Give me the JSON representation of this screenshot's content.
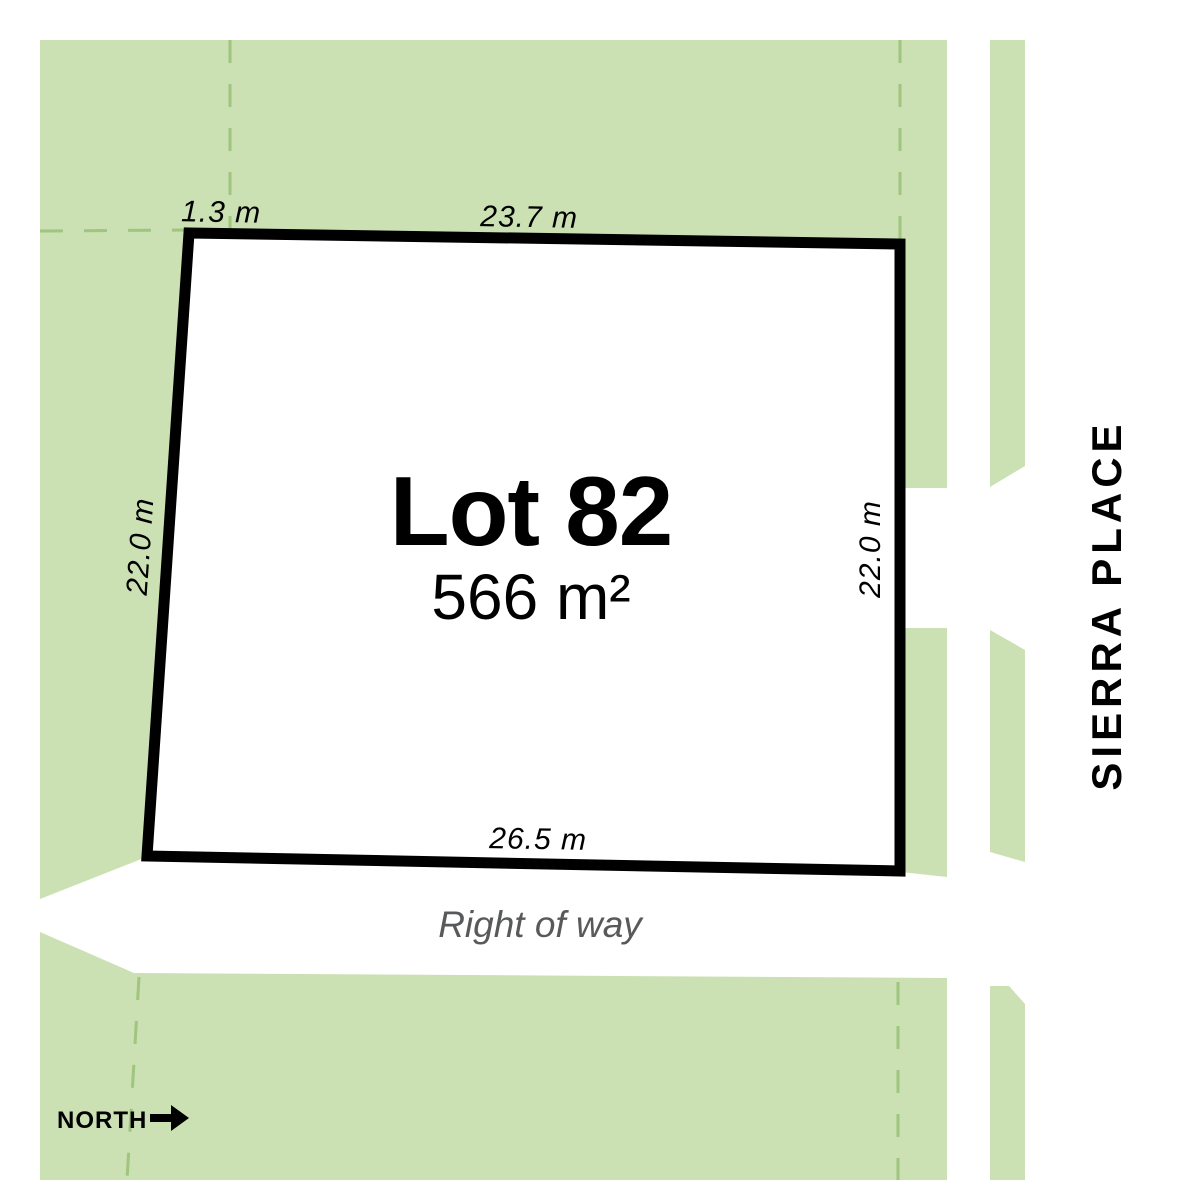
{
  "plan": {
    "lot": {
      "title": "Lot 82",
      "area": "566 m²"
    },
    "dimensions": {
      "top_offset": "1.3 m",
      "top": "23.7 m",
      "left": "22.0 m",
      "right": "22.0 m",
      "bottom": "26.5 m"
    },
    "right_of_way": {
      "label": "Right of way"
    },
    "street": {
      "name": "SIERRA PLACE"
    },
    "compass": {
      "label": "NORTH",
      "direction": "east"
    },
    "colors": {
      "parcel-green": "#cbe0b3",
      "dash-green": "#9fc57e",
      "boundary-black": "#000000",
      "row-gray": "#58595b"
    }
  }
}
